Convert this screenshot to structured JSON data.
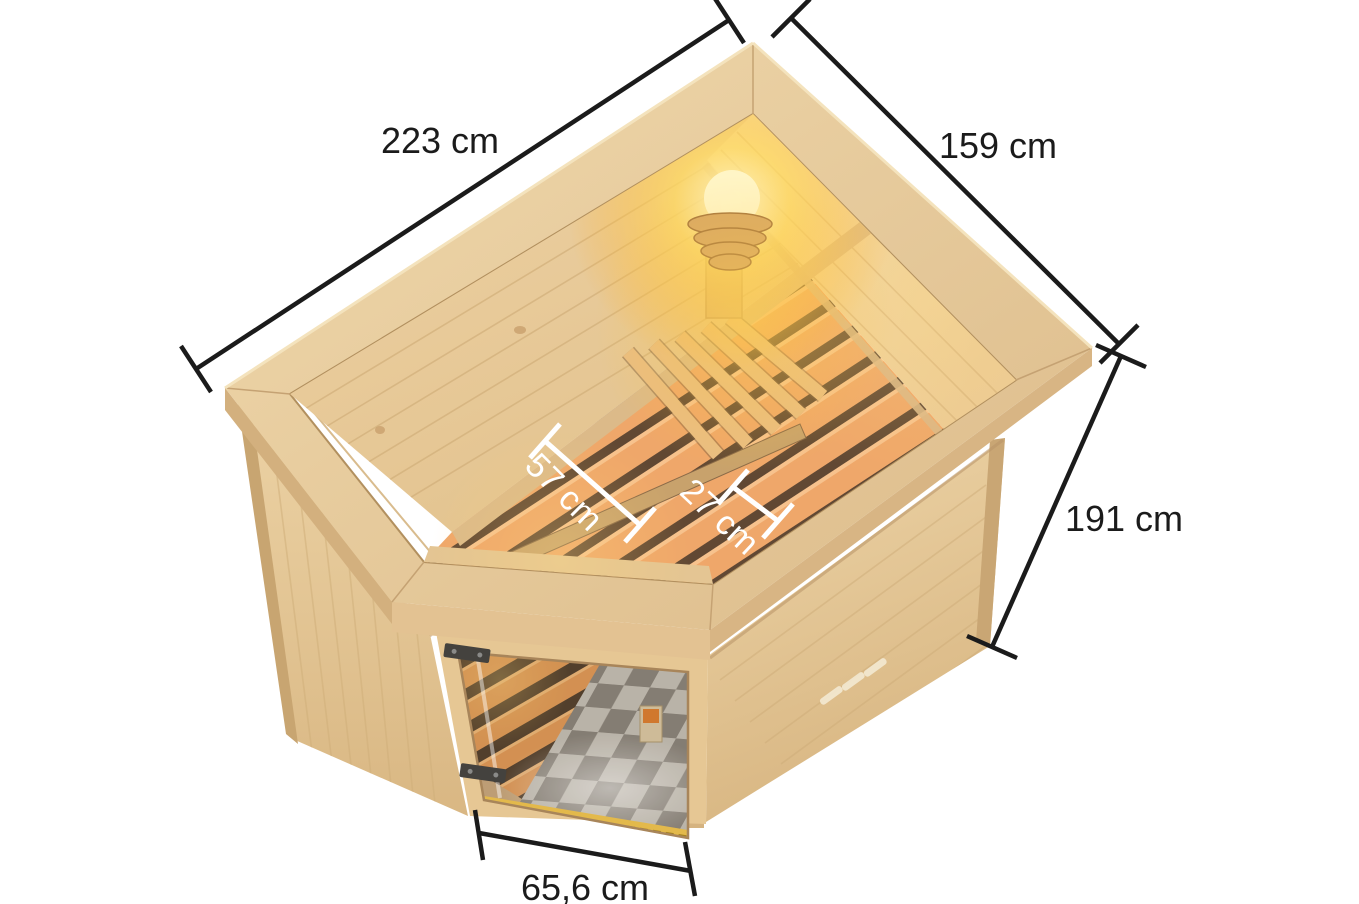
{
  "diagram": {
    "background_color": "#ffffff",
    "dimensions": {
      "back_left_edge": "223 cm",
      "back_right_edge": "159 cm",
      "height": "191 cm",
      "door_width": "65,6 cm",
      "bench_main": "57 cm",
      "bench_front": "27 cm"
    },
    "colors": {
      "dimension_line": "#1b1b1b",
      "dimension_text": "#1b1b1b",
      "interior_dimension": "#ffffff",
      "wood_crown": "#e4c593",
      "wood_wall_exterior": "#e7cb9c",
      "wood_wall_interior": "#e9cda0",
      "bench_slat": "#efa76a",
      "bench_gap": "#614833",
      "lamp_glow": "#ffd76a",
      "floor_light": "#c6c1b8",
      "floor_dark": "#8b857d",
      "hinge_metal": "#44423e",
      "threshold_gold": "#e3b94b"
    }
  }
}
